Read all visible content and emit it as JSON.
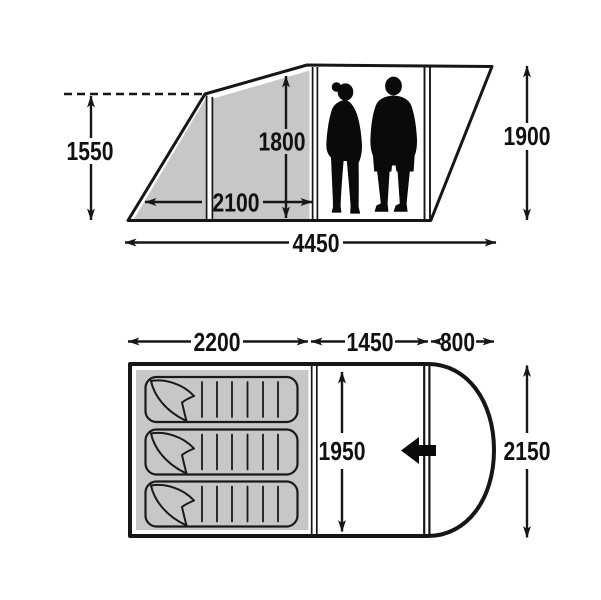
{
  "colors": {
    "background": "#ffffff",
    "line": "#161616",
    "shade_gray": "#c7c7c7",
    "text": "#111111",
    "figure_black": "#0a0a0a"
  },
  "side_view": {
    "awning_peak_height_mm": "1550",
    "awning_depth_mm": "2100",
    "interior_height_mm": "1800",
    "rear_height_mm": "1900",
    "total_length_mm": "4450"
  },
  "floor_plan": {
    "bedroom_length_mm": "2200",
    "living_area_length_mm": "1450",
    "porch_depth_mm": "800",
    "interior_width_mm": "1950",
    "overall_width_mm": "2150",
    "sleeping_mat_count": 3
  }
}
